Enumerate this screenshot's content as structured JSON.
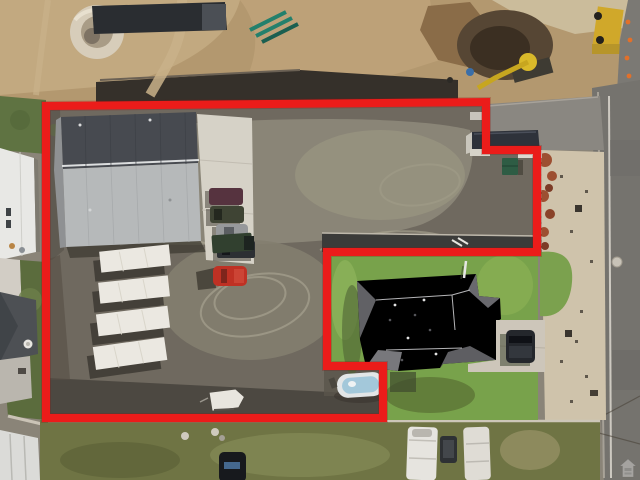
{
  "image": {
    "type": "aerial-drone-photograph",
    "subject": "Top-down aerial photo of a commercial parcel with warehouse, gravel yard, four parked semi-trailers and vehicles; a neighboring house lot is carved out of the outlined boundary; construction dirt site to the north; road along the east edge",
    "orientation": "top-down"
  },
  "boundary": {
    "label": "parcel-outline",
    "color": "#eb1c1a",
    "shadow_color": "#8f0f0c",
    "stroke_width": 8,
    "points": "46,106 486,102 486,150 537,150 537,252 327,252 327,366 383,366 383,418 46,418"
  },
  "watermark": {
    "icon": "house-logo-icon",
    "corner": "bottom-right",
    "opacity": 0.55
  },
  "palette": {
    "dirt_north": "#b3986f",
    "yard_dark": "#6f695f",
    "yard_light": "#8a8577",
    "asphalt_south": "#4c4841",
    "warehouse_roof_dark": "#474a50",
    "warehouse_roof_light": "#b6b9ba",
    "concrete_apron": "#d6d2c7",
    "trailer_white": "#ebe8e1",
    "red_car": "#bf3124",
    "lawn_green": "#78a24b",
    "road_gray": "#75736e",
    "parkstrip_tan": "#cfc3ab"
  },
  "objects": {
    "warehouse_count": 1,
    "semi_trailer_count": 4,
    "red_car_count": 1,
    "boat_count": 1,
    "rv_count": 2,
    "excluded_house_count": 1,
    "excavator_count": 1
  }
}
